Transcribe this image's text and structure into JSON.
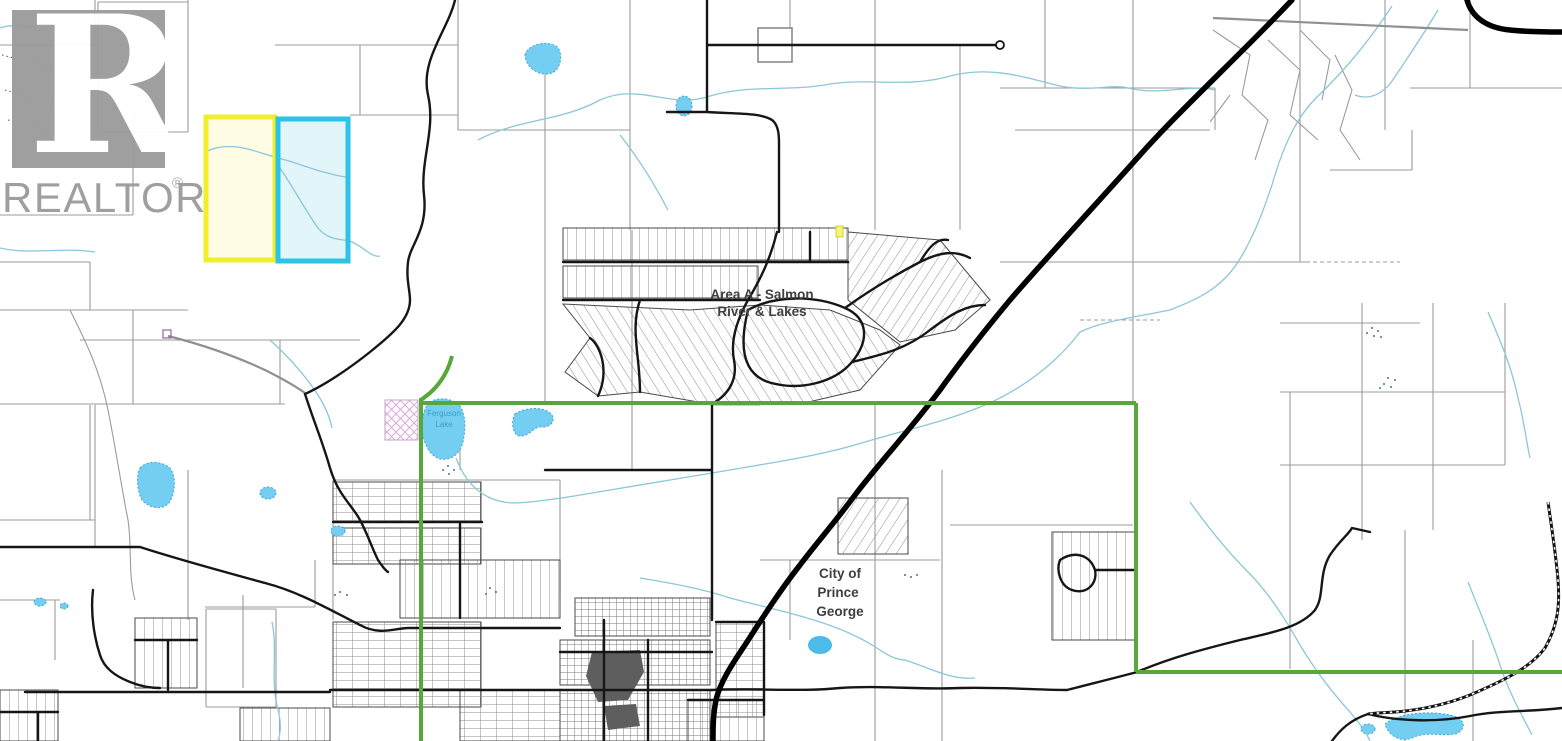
{
  "watermark": {
    "logo_letter": "R",
    "brand": "REALTOR",
    "registered_mark": "®"
  },
  "labels": {
    "area_a": {
      "line1": "Area A - Salmon",
      "line2": "River & Lakes"
    },
    "city": {
      "line1": "City of",
      "line2": "Prince",
      "line3": "George"
    },
    "ferguson_lake": {
      "line1": "Ferguson",
      "line2": "Lake"
    }
  },
  "colors": {
    "highlight_yellow_border": "#f0ee2e",
    "highlight_yellow_fill": "#fffce4",
    "highlight_cyan_border": "#2bc3e6",
    "highlight_cyan_fill": "#e2f6fa",
    "city_boundary_green": "#57a73a",
    "lake_fill_blue": "#74cef2",
    "stream_blue": "#8cc6da",
    "road_black": "#161616",
    "parcel_line_gray": "#9b9b9b",
    "watermark_gray": "#9c9c9c"
  }
}
